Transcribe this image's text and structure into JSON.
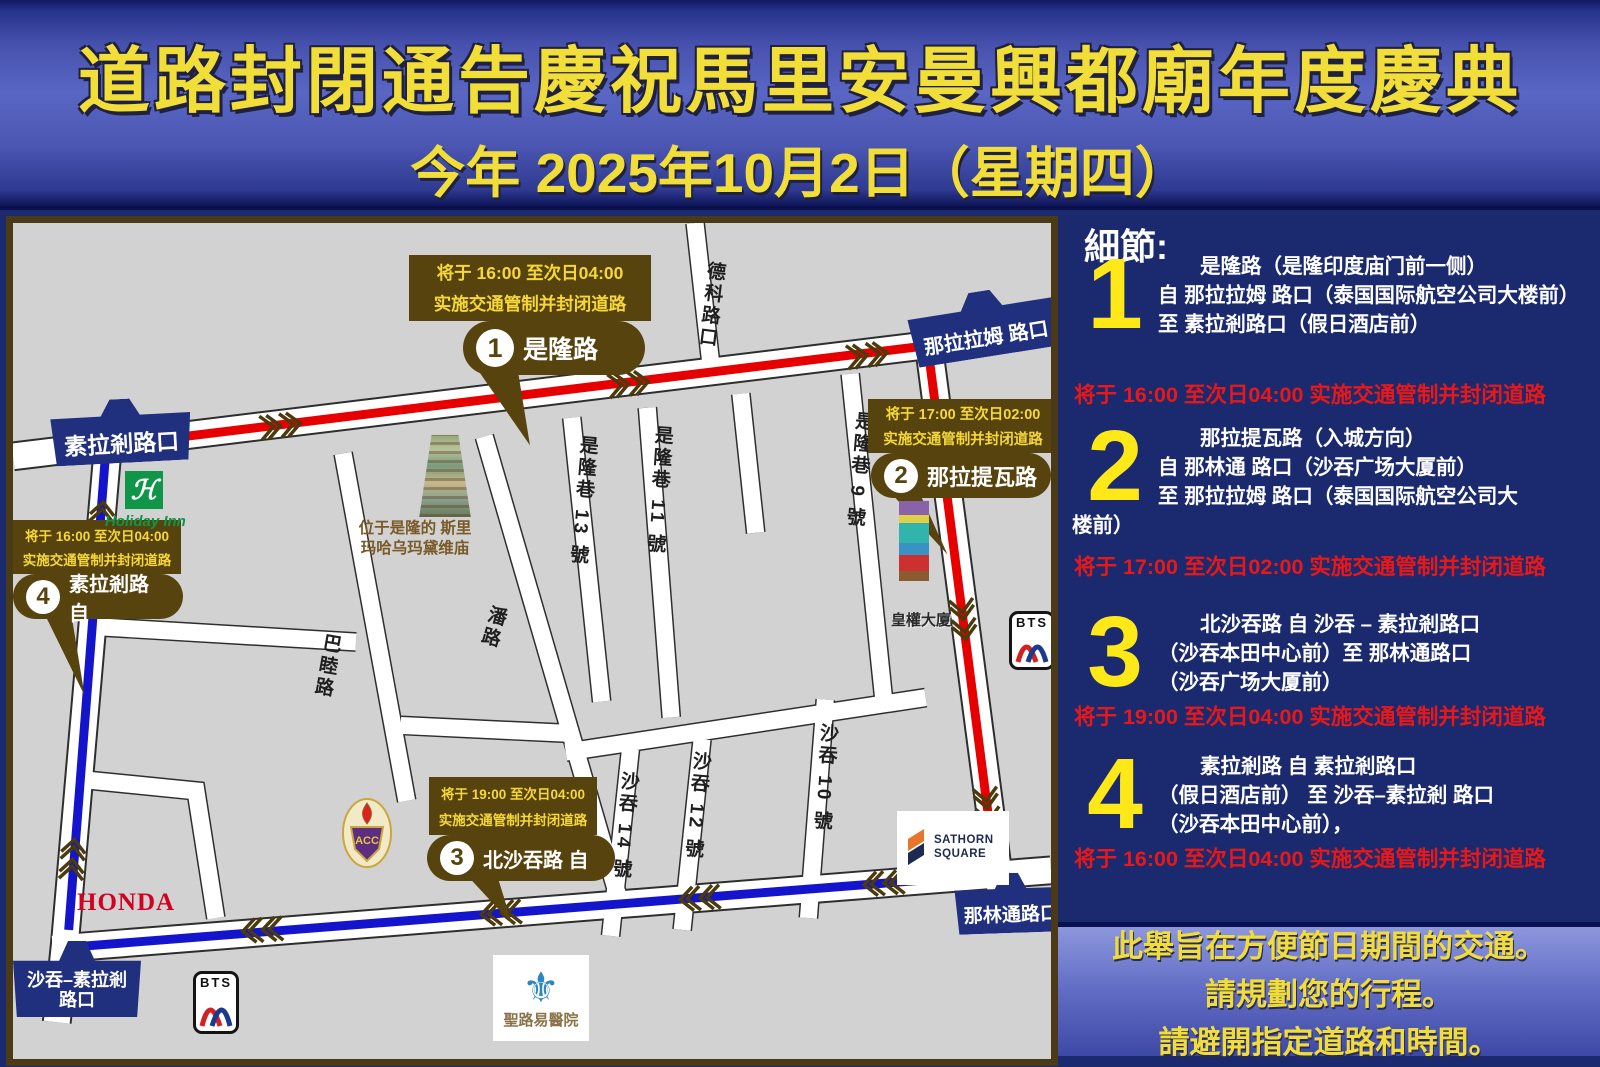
{
  "header": {
    "title": "道路封閉通告慶祝馬里安曼興都廟年度慶典",
    "subtitle": "今年 2025年10月2日（星期四）"
  },
  "details": {
    "heading": "細節:",
    "items": [
      {
        "num": "1",
        "lines": [
          "是隆路（是隆印度庙门前一侧）",
          "自 那拉拉姆 路口（泰国国际航空公司大楼前）",
          "至 素拉剎路口（假日酒店前）"
        ],
        "time": "将于 16:00 至次日04:00 实施交通管制并封闭道路"
      },
      {
        "num": "2",
        "lines": [
          "那拉提瓦路（入城方向）",
          "自 那林通 路口（沙吞广场大厦前）",
          "至 那拉拉姆 路口（泰国国际航空公司大",
          "楼前）"
        ],
        "time": "将于 17:00 至次日02:00 实施交通管制并封闭道路"
      },
      {
        "num": "3",
        "lines": [
          "北沙吞路 自 沙吞 – 素拉剎路口",
          "（沙吞本田中心前）至 那林通路口",
          "（沙吞广场大厦前）"
        ],
        "time": "将于 19:00 至次日04:00 实施交通管制并封闭道路"
      },
      {
        "num": "4",
        "lines": [
          "素拉剎路 自 素拉剎路口",
          "（假日酒店前） 至 沙吞–素拉剎 路口",
          "（沙吞本田中心前），"
        ],
        "time": "将于 16:00 至次日04:00 实施交通管制并封闭道路"
      }
    ]
  },
  "notice": {
    "lines": [
      "此舉旨在方便節日期間的交通。",
      "請規劃您的行程。",
      "請避開指定道路和時間。"
    ]
  },
  "map": {
    "callouts": [
      {
        "time1": "将于 16:00 至次日04:00",
        "time2": "实施交通管制并封闭道路",
        "num": "1",
        "label": "是隆路"
      },
      {
        "time1": "将于 17:00 至次日02:00",
        "time2": "实施交通管制并封闭道路",
        "num": "2",
        "label": "那拉提瓦路"
      },
      {
        "time1": "将于 19:00 至次日04:00",
        "time2": "实施交通管制并封闭道路",
        "num": "3",
        "label": "北沙吞路 自"
      },
      {
        "time1": "将于 16:00 至次日04:00",
        "time2": "实施交通管制并封闭道路",
        "num": "4",
        "label": "素拉剎路 自"
      }
    ],
    "signs": {
      "surasak": "素拉剎路口",
      "nararam": "那拉拉姆 路口",
      "narinthon": "那林通路口",
      "sathon_surasak_line1": "沙吞–素拉剎",
      "sathon_surasak_line2": "路口"
    },
    "streets": {
      "deco": "德科路口",
      "silom13": "是隆巷 13 號",
      "silom11": "是隆巷 11 號",
      "silom9": "是隆巷 9 號",
      "pan": "潘路",
      "bamu": "巴睦路",
      "sathon14": "沙吞 14 號",
      "sathon12": "沙吞 12 號",
      "sathon10": "沙吞 10 號"
    },
    "pois": {
      "temple_line1": "位于是隆的 斯里",
      "temple_line2": "玛哈乌玛黛维庙",
      "tower": "皇權大廈",
      "holiday_inn": "Holiday Inn",
      "holiday_inn_h": "ℋ",
      "honda": "HONDA",
      "bts": "BTS",
      "acc_crest": "ACC",
      "sathorn_square_line1": "SATHORN",
      "sathorn_square_line2": "SQUARE",
      "st_louis": "聖路易醫院"
    },
    "colors": {
      "route_red": "#e60000",
      "route_blue": "#1414cc",
      "callout_brown": "#57430e",
      "sign_navy": "#20307f",
      "accent_yellow": "#ffe818",
      "alert_red": "#e81818"
    }
  }
}
